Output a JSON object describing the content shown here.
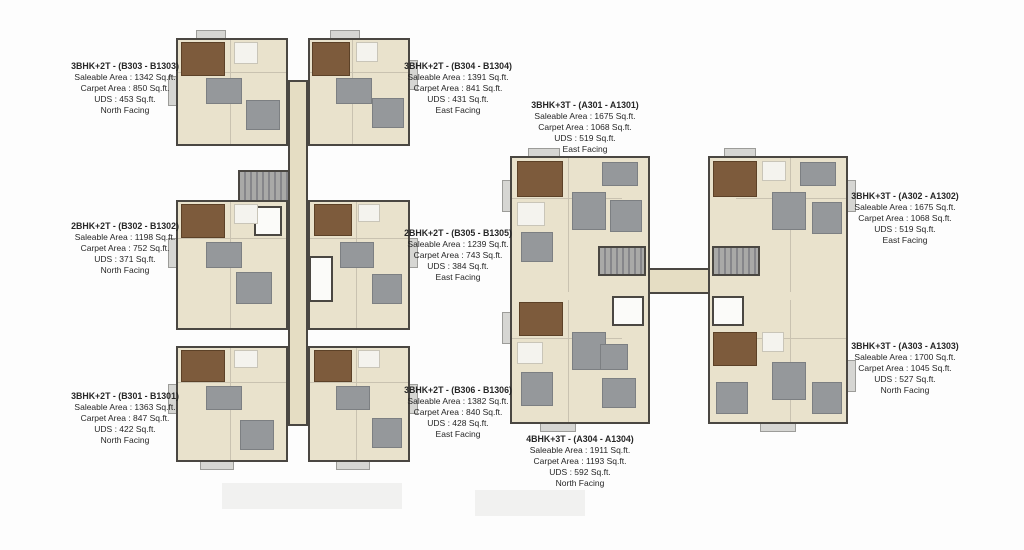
{
  "units": [
    {
      "id": "B303",
      "title": "3BHK+2T - (B303 - B1303)",
      "saleable": "Saleable Area : 1342 Sq.ft.",
      "carpet": "Carpet Area : 850 Sq.ft.",
      "uds": "UDS : 453 Sq.ft.",
      "facing": "North Facing"
    },
    {
      "id": "B302",
      "title": "2BHK+2T - (B302 - B1302)",
      "saleable": "Saleable Area : 1198 Sq.ft.",
      "carpet": "Carpet Area : 752 Sq.ft.",
      "uds": "UDS : 371 Sq.ft.",
      "facing": "North Facing"
    },
    {
      "id": "B301",
      "title": "3BHK+2T - (B301 - B1301)",
      "saleable": "Saleable Area : 1363 Sq.ft.",
      "carpet": "Carpet Area : 847 Sq.ft.",
      "uds": "UDS : 422 Sq.ft.",
      "facing": "North Facing"
    },
    {
      "id": "B304",
      "title": "3BHK+2T - (B304 - B1304)",
      "saleable": "Saleable Area : 1391 Sq.ft.",
      "carpet": "Carpet Area : 841 Sq.ft.",
      "uds": "UDS : 431 Sq.ft.",
      "facing": "East Facing"
    },
    {
      "id": "B305",
      "title": "2BHK+2T - (B305 - B1305)",
      "saleable": "Saleable Area : 1239 Sq.ft.",
      "carpet": "Carpet Area : 743 Sq.ft.",
      "uds": "UDS : 384 Sq.ft.",
      "facing": "East Facing"
    },
    {
      "id": "B306",
      "title": "3BHK+2T - (B306 - B1306)",
      "saleable": "Saleable Area : 1382 Sq.ft.",
      "carpet": "Carpet Area : 840 Sq.ft.",
      "uds": "UDS : 428 Sq.ft.",
      "facing": "East Facing"
    },
    {
      "id": "A301",
      "title": "3BHK+3T - (A301 - A1301)",
      "saleable": "Saleable Area : 1675 Sq.ft.",
      "carpet": "Carpet Area : 1068 Sq.ft.",
      "uds": "UDS : 519 Sq.ft.",
      "facing": "East Facing"
    },
    {
      "id": "A302",
      "title": "3BHK+3T - (A302 - A1302)",
      "saleable": "Saleable Area : 1675 Sq.ft.",
      "carpet": "Carpet Area : 1068 Sq.ft.",
      "uds": "UDS : 519 Sq.ft.",
      "facing": "East Facing"
    },
    {
      "id": "A303",
      "title": "3BHK+3T - (A303 - A1303)",
      "saleable": "Saleable Area : 1700 Sq.ft.",
      "carpet": "Carpet Area : 1045 Sq.ft.",
      "uds": "UDS : 527 Sq.ft.",
      "facing": "North Facing"
    },
    {
      "id": "A304",
      "title": "4BHK+3T - (A304 - A1304)",
      "saleable": "Saleable Area : 1911 Sq.ft.",
      "carpet": "Carpet Area : 1193 Sq.ft.",
      "uds": "UDS : 592 Sq.ft.",
      "facing": "North Facing"
    }
  ],
  "colors": {
    "floor_cream": "#e9e2cc",
    "wall_dark": "#4a4742",
    "master_bedroom_brown": "#7d5b3c",
    "furniture_gray": "#95989b",
    "balcony_gray": "#d6d6d3",
    "bath_white": "#f4f3ee",
    "text": "#262626"
  }
}
